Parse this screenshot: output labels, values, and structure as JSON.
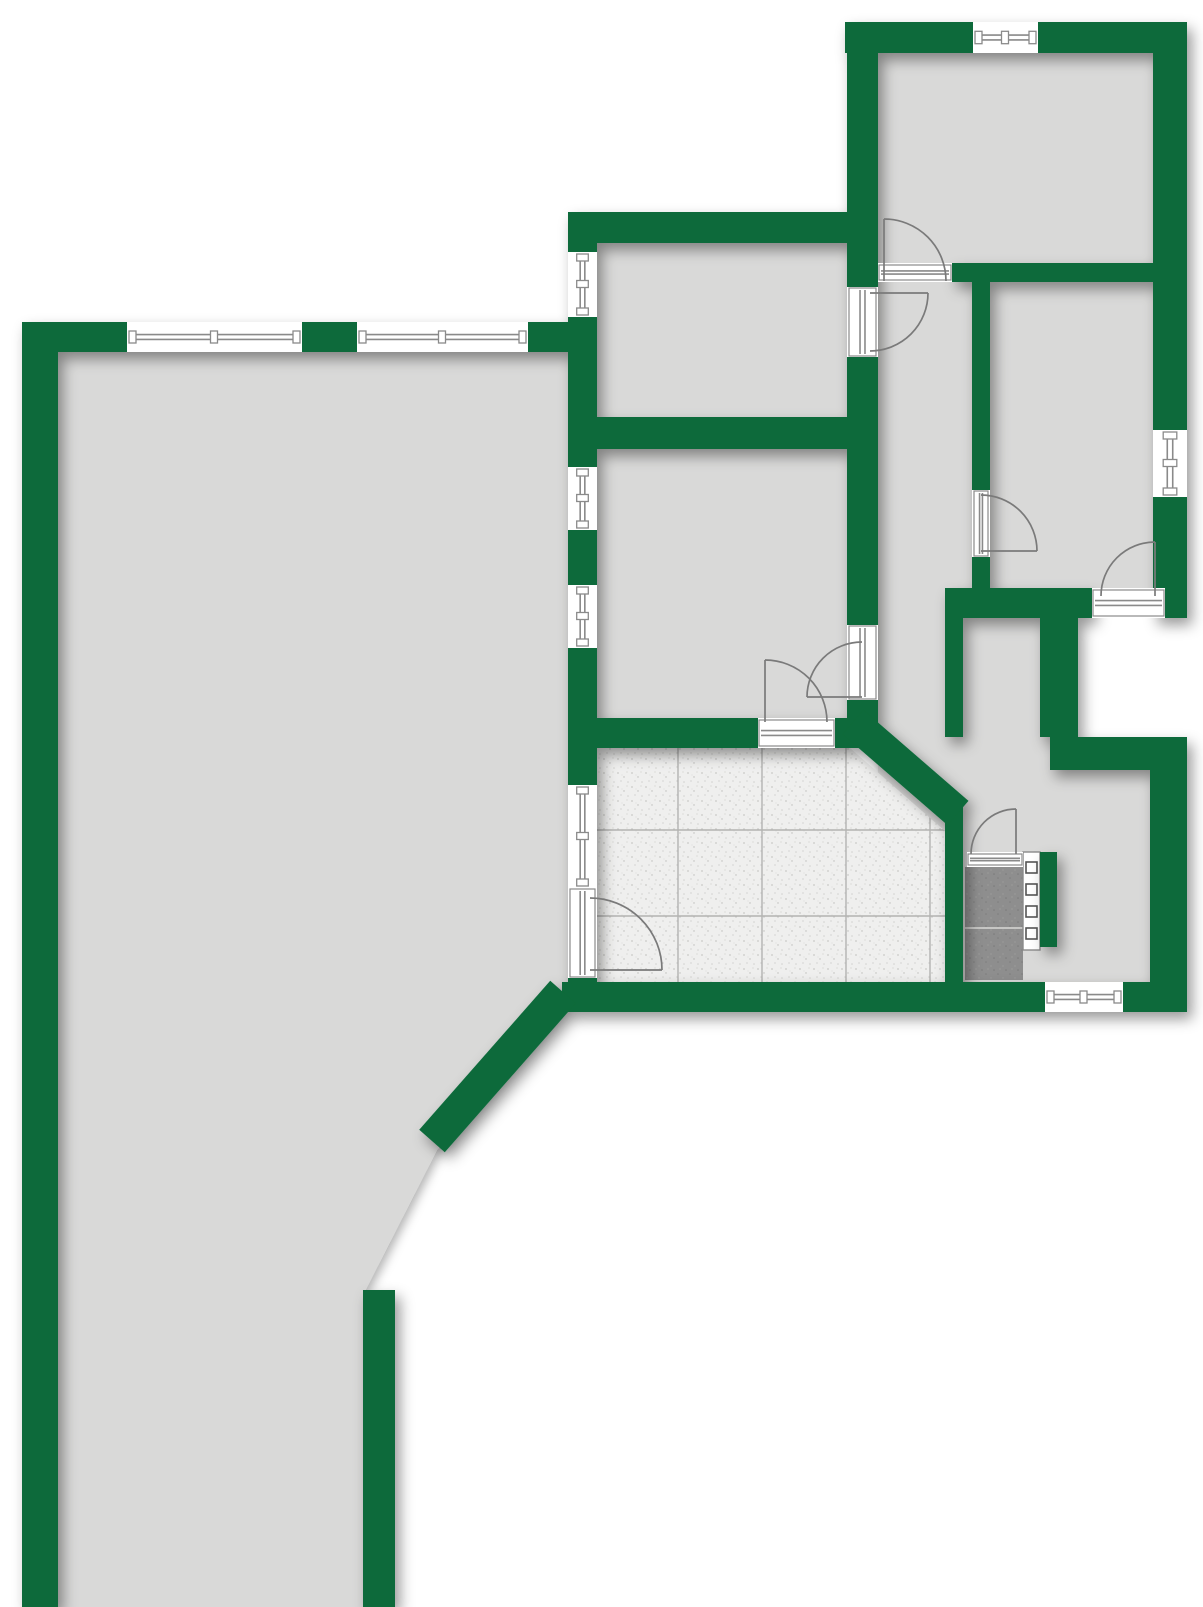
{
  "plan": {
    "name": "apartment-floor-plan",
    "canvas": {
      "width": 1203,
      "height": 1607
    },
    "colors": {
      "wall_green": "#0a6b3a",
      "floor_gray": "#d9d9d8",
      "background": "#ffffff",
      "symbol_line": "#8a8a8a",
      "tile_base": "#efefee",
      "tile_grid": "#b3b3b1",
      "dark_cell": "#8e8e8e",
      "dark_cell_divider": "#c6c6c4",
      "shadow": "#5a6660"
    },
    "rooms": [
      {
        "name": "living-area-floor",
        "type": "polygon",
        "points": "58,352 568,352 568,1000 437,1150 363,1295 363,1607 58,1607"
      },
      {
        "name": "room-top-middle-floor",
        "type": "rect",
        "x": 597,
        "y": 243,
        "w": 250,
        "h": 174
      },
      {
        "name": "room-middle-floor",
        "type": "rect",
        "x": 597,
        "y": 449,
        "w": 250,
        "h": 276
      },
      {
        "name": "room-top-right-floor",
        "type": "rect",
        "x": 878,
        "y": 53,
        "w": 275,
        "h": 210
      },
      {
        "name": "room-right-floor",
        "type": "rect",
        "x": 972,
        "y": 282,
        "w": 181,
        "h": 306
      },
      {
        "name": "hallway-floor",
        "type": "rect",
        "x": 878,
        "y": 282,
        "w": 94,
        "h": 548
      },
      {
        "name": "hall-lower-floor",
        "type": "rect",
        "x": 963,
        "y": 607,
        "w": 187,
        "h": 375
      }
    ],
    "loggia_notch": {
      "x": 1078,
      "y": 618,
      "w": 114,
      "h": 119
    },
    "walls": [
      {
        "x": 22,
        "y": 322,
        "w": 36,
        "h": 1285
      },
      {
        "x": 22,
        "y": 322,
        "w": 548,
        "h": 30
      },
      {
        "x": 568,
        "y": 212,
        "w": 29,
        "h": 778
      },
      {
        "x": 568,
        "y": 212,
        "w": 310,
        "h": 31
      },
      {
        "x": 568,
        "y": 417,
        "w": 310,
        "h": 32
      },
      {
        "x": 568,
        "y": 718,
        "w": 310,
        "h": 30
      },
      {
        "x": 847,
        "y": 53,
        "w": 31,
        "h": 665
      },
      {
        "x": 845,
        "y": 22,
        "w": 342,
        "h": 31
      },
      {
        "x": 1153,
        "y": 22,
        "w": 34,
        "h": 596
      },
      {
        "x": 952,
        "y": 263,
        "w": 201,
        "h": 19
      },
      {
        "x": 972,
        "y": 282,
        "w": 18,
        "h": 306
      },
      {
        "x": 950,
        "y": 588,
        "w": 142,
        "h": 30
      },
      {
        "x": 1165,
        "y": 588,
        "w": 22,
        "h": 30
      },
      {
        "x": 945,
        "y": 588,
        "w": 18,
        "h": 149
      },
      {
        "x": 1040,
        "y": 618,
        "w": 38,
        "h": 119
      },
      {
        "x": 1050,
        "y": 737,
        "w": 137,
        "h": 33
      },
      {
        "x": 1150,
        "y": 770,
        "w": 37,
        "h": 242
      },
      {
        "x": 562,
        "y": 982,
        "w": 625,
        "h": 30
      },
      {
        "x": 945,
        "y": 800,
        "w": 18,
        "h": 212
      },
      {
        "x": 1040,
        "y": 852,
        "w": 17,
        "h": 95
      },
      {
        "x": 363,
        "y": 1290,
        "w": 32,
        "h": 317
      }
    ],
    "diagonal_walls": [
      {
        "x1": 563,
        "y1": 992,
        "x2": 432,
        "y2": 1141,
        "w": 34
      },
      {
        "x1": 853,
        "y1": 722,
        "x2": 958,
        "y2": 813,
        "w": 32
      }
    ],
    "windows": [
      {
        "x": 127,
        "y": 322,
        "w": 175,
        "h": 30,
        "o": "h"
      },
      {
        "x": 357,
        "y": 322,
        "w": 171,
        "h": 30,
        "o": "h"
      },
      {
        "x": 568,
        "y": 252,
        "w": 29,
        "h": 65,
        "o": "v"
      },
      {
        "x": 568,
        "y": 467,
        "w": 29,
        "h": 63,
        "o": "v"
      },
      {
        "x": 568,
        "y": 585,
        "w": 29,
        "h": 63,
        "o": "v"
      },
      {
        "x": 568,
        "y": 785,
        "w": 29,
        "h": 103,
        "o": "v"
      },
      {
        "x": 973,
        "y": 22,
        "w": 65,
        "h": 31,
        "o": "h"
      },
      {
        "x": 1153,
        "y": 430,
        "w": 34,
        "h": 67,
        "o": "v"
      },
      {
        "x": 1045,
        "y": 982,
        "w": 78,
        "h": 30,
        "o": "h"
      }
    ],
    "door_openings": [
      {
        "x": 878,
        "y": 263,
        "w": 74,
        "h": 19,
        "o": "h"
      },
      {
        "x": 847,
        "y": 287,
        "w": 31,
        "h": 70,
        "o": "v"
      },
      {
        "x": 972,
        "y": 490,
        "w": 18,
        "h": 67,
        "o": "v"
      },
      {
        "x": 847,
        "y": 625,
        "w": 31,
        "h": 75,
        "o": "v"
      },
      {
        "x": 758,
        "y": 718,
        "w": 77,
        "h": 30,
        "o": "h"
      },
      {
        "x": 568,
        "y": 888,
        "w": 29,
        "h": 90,
        "o": "v"
      },
      {
        "x": 1092,
        "y": 588,
        "w": 73,
        "h": 30,
        "o": "h"
      },
      {
        "x": 967,
        "y": 852,
        "w": 56,
        "h": 15,
        "o": "h"
      }
    ],
    "door_swings": [
      {
        "arc": "M 884 219 A 62 62 0 0 1 946 281",
        "leaf": [
          884,
          281,
          884,
          219
        ]
      },
      {
        "arc": "M 928 293 A 58 58 0 0 1 870 351",
        "leaf": [
          870,
          293,
          928,
          293
        ]
      },
      {
        "arc": "M 981 495 A 56 56 0 0 1 1037 551",
        "leaf": [
          981,
          551,
          1037,
          551
        ]
      },
      {
        "arc": "M 862 642 A 55 55 0 0 0 807 697",
        "leaf": [
          807,
          697,
          862,
          697
        ]
      },
      {
        "arc": "M 765 660 A 62 62 0 0 1 827 722",
        "leaf": [
          765,
          722,
          765,
          660
        ]
      },
      {
        "arc": "M 590 898 A 72 72 0 0 1 662 970",
        "leaf": [
          590,
          970,
          662,
          970
        ]
      },
      {
        "arc": "M 1155 542 A 54 54 0 0 0 1101 596",
        "leaf": [
          1155,
          596,
          1155,
          542
        ]
      },
      {
        "arc": "M 971 854 A 45 45 0 0 1 1016 809",
        "leaf": [
          1016,
          854,
          1016,
          809
        ]
      }
    ],
    "kitchen_tiles": {
      "polygon": "597,748 850,748 945,831 945,982 591,982 591,785 597,785",
      "grid_vertical_x": [
        678,
        762,
        846,
        930
      ],
      "grid_horizontal_y": [
        830,
        916
      ],
      "grid_top": 748,
      "grid_bottom": 982,
      "grid_left": 591,
      "grid_right": 945
    },
    "dark_cell": {
      "x": 965,
      "y": 867,
      "w": 58,
      "h": 113,
      "divider_y": 928
    },
    "radiator": {
      "x": 1023,
      "y": 852,
      "w": 17,
      "h": 98,
      "square_x": 1026,
      "square_w": 11,
      "square_h": 11,
      "squares_y": [
        862,
        884,
        906,
        928
      ]
    }
  }
}
